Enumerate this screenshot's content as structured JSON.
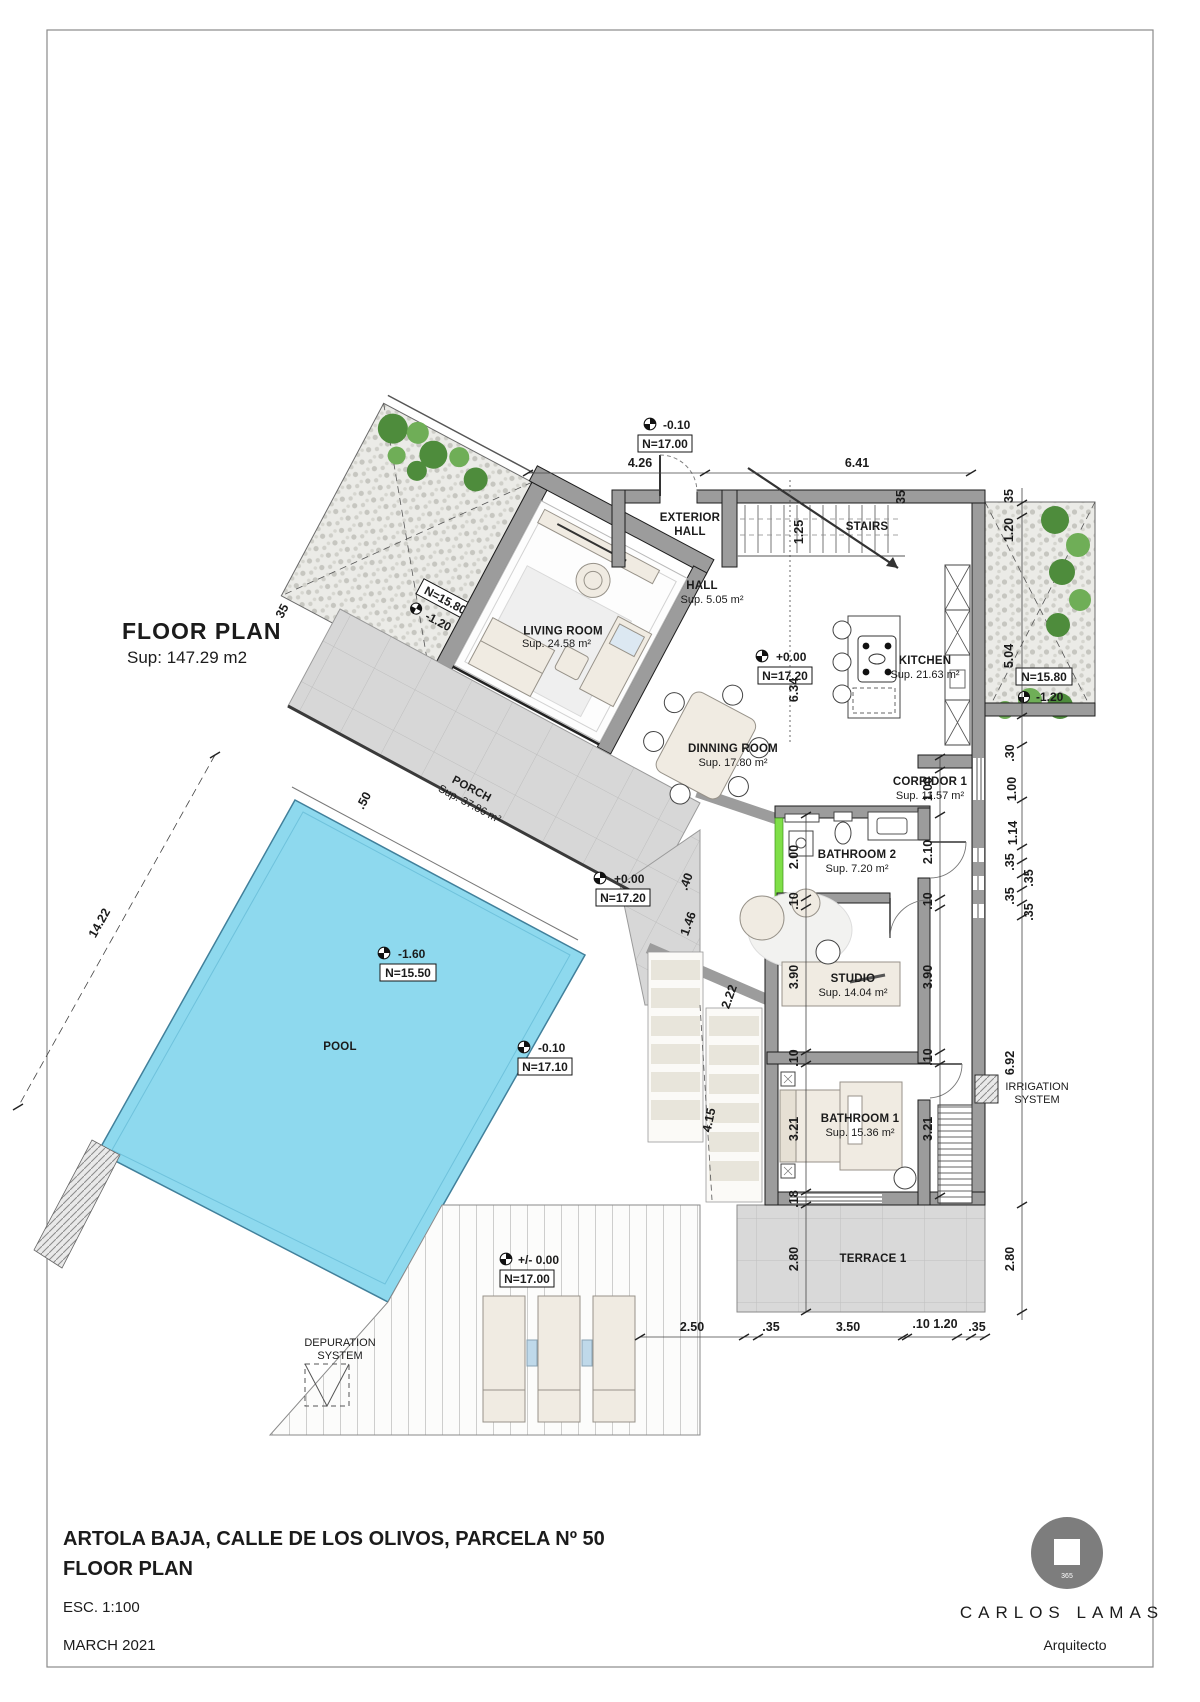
{
  "header": {
    "plan_title": "FLOOR PLAN",
    "plan_area": "Sup: 147.29 m2"
  },
  "rooms": {
    "exterior_hall_l1": "EXTERIOR",
    "exterior_hall_l2": "HALL",
    "hall": "HALL",
    "hall_area": "Sup. 5.05 m²",
    "stairs": "STAIRS",
    "living": "LIVING ROOM",
    "living_area": "Sup. 24.58 m²",
    "kitchen": "KITCHEN",
    "kitchen_area": "Sup. 21.63 m²",
    "dinning": "DINNING ROOM",
    "dinning_area": "Sup. 17.80 m²",
    "corridor": "CORRIDOR 1",
    "corridor_area": "Sup. 11.57 m²",
    "bathroom2": "BATHROOM 2",
    "bathroom2_area": "Sup. 7.20 m²",
    "studio": "STUDIO",
    "studio_area": "Sup. 14.04 m²",
    "bathroom1": "BATHROOM 1",
    "bathroom1_area": "Sup. 15.36 m²",
    "porch": "PORCH",
    "porch_area": "Sup. 37.86 m²",
    "pool": "POOL",
    "terrace": "TERRACE 1",
    "depuration_l1": "DEPURATION",
    "depuration_l2": "SYSTEM",
    "irrigation_l1": "IRRIGATION",
    "irrigation_l2": "SYSTEM"
  },
  "levels": {
    "entry": {
      "value": "-0.10",
      "ref": "N=17.00"
    },
    "main": {
      "value": "+0.00",
      "ref": "N=17.20"
    },
    "hall_mid": {
      "value": "+0.00",
      "ref": "N=17.20"
    },
    "pool": {
      "value": "-1.60",
      "ref": "N=15.50"
    },
    "deck_low": {
      "value": "-0.10",
      "ref": "N=17.10"
    },
    "deck": {
      "value": "+/-  0.00",
      "ref": "N=17.00"
    },
    "garden_left": {
      "value": "-1.20",
      "ref": "N=15.80"
    },
    "garden_right": {
      "value": "-1.20",
      "ref": "N=15.80"
    }
  },
  "dims": {
    "top_a": "4.26",
    "top_b": "6.41",
    "wall_35": "35",
    "stair_w": "1.25",
    "mid_h": "6.34",
    "r1": "35",
    "r2": "1.20",
    "r3": "5.04",
    "r4": ".30",
    "r5": "1.00",
    "r6": "1.14",
    "r7": ".35",
    "r8": ".35",
    "r9": ".35",
    "r10": ".35",
    "r11": "6.92",
    "r12": "2.80",
    "c1": "1.00",
    "c2": "2.10",
    "c3": ".10",
    "c4": "3.90",
    "c5": ".10",
    "c6": "3.21",
    "l1": "2.00",
    "l2": ".10",
    "l3": "3.90",
    "l4": ".10",
    "l5": "3.21",
    "l6": ".18",
    "l7": "2.80",
    "o1": ".40",
    "o2": "1.46",
    "o3": "2.22",
    "o4": "4.15",
    "b1": "2.50",
    "b2": ".35",
    "b3": "3.50",
    "b4": ".10 1.20",
    "b5": ".35",
    "w1": "5.29",
    "w2": "35",
    "w3": "35",
    "w4": "2.50",
    "w5": ".50",
    "w6": "35",
    "w7": "14.22"
  },
  "titleblock": {
    "address": "ARTOLA BAJA, CALLE DE LOS OLIVOS, PARCELA Nº 50",
    "drawing": "FLOOR PLAN",
    "scale": "ESC. 1:100",
    "date": "MARCH  2021",
    "architect": "CARLOS LAMAS",
    "role": "Arquitecto",
    "logo_number": "365"
  },
  "colors": {
    "pool": "#8ED9EE",
    "tile": "#D7D7D7",
    "wall": "#9C9C9C",
    "plant": "#4E8C3C",
    "accent_wall": "#7FDF48"
  }
}
